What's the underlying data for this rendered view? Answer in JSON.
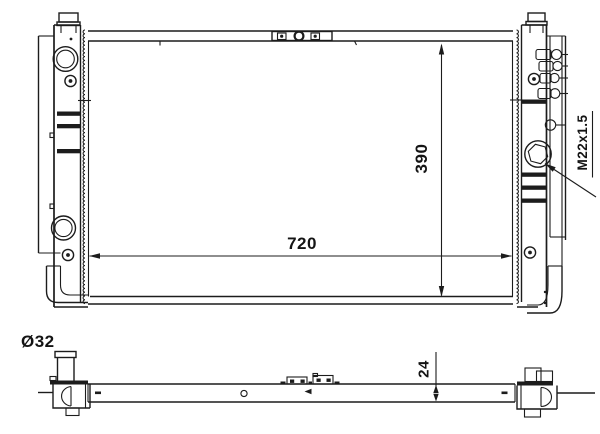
{
  "annotations": {
    "core_width": "720",
    "core_height": "390",
    "core_depth": "24",
    "inlet_diameter": "Ø32",
    "thread_spec": "M22x1.5"
  },
  "colors": {
    "background": "#ffffff",
    "line": "#1c1c1c"
  }
}
